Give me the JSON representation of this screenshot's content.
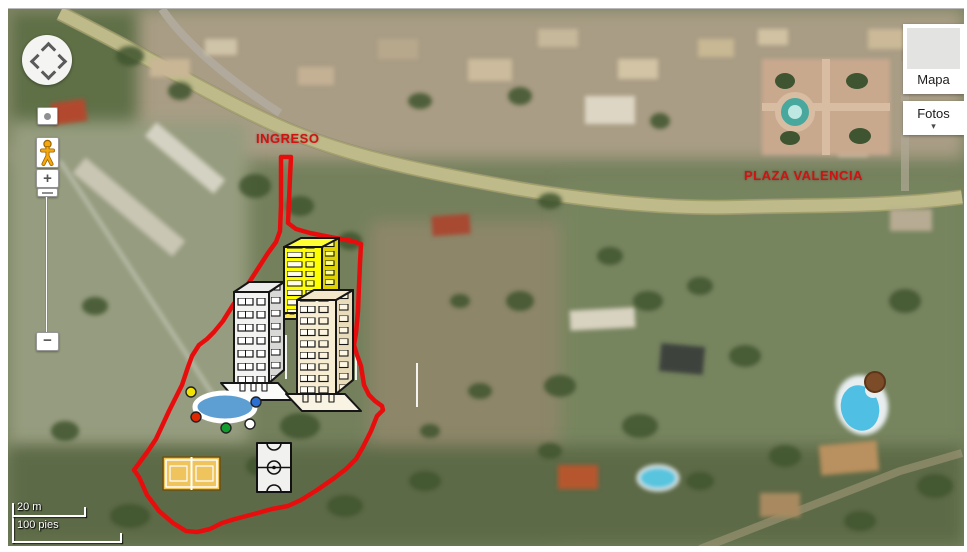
{
  "ui": {
    "map_type_panel": {
      "mapa_label": "Mapa",
      "fotos_label": "Fotos",
      "fotos_caret": "▾"
    },
    "zoom_control": {
      "zoom_in": "+",
      "zoom_out": "−"
    },
    "scale_bar": {
      "metric_label": "20 m",
      "imperial_label": "100 pies"
    }
  },
  "annotations": {
    "entrance_label": "INGRESO",
    "plaza_label": "PLAZA VALENCIA",
    "colors": {
      "boundary": "#e80d0d",
      "pool_water": "#5d9fd3",
      "court_fill": "#efc45c",
      "soccer_fill": "#f1f1ef",
      "tower_yellow": "#ffff00",
      "tower_gray": "#f3f3f1",
      "tower_beige": "#f7edd3"
    }
  }
}
